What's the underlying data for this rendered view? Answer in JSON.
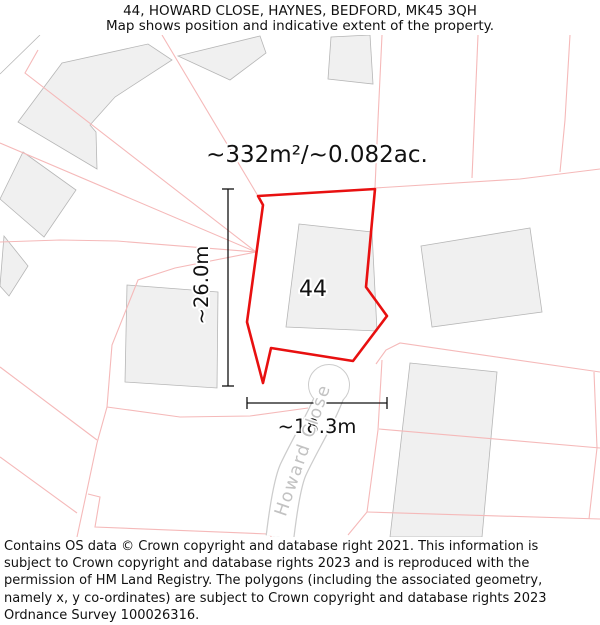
{
  "header": {
    "title": "44, HOWARD CLOSE, HAYNES, BEDFORD, MK45 3QH",
    "subtitle": "Map shows position and indicative extent of the property."
  },
  "map": {
    "area_label": "~332m²/~0.082ac.",
    "plot_number": "44",
    "street_name": "Howard Close",
    "dimensions": {
      "height_label": "~26.0m",
      "width_label": "~18.3m"
    },
    "property_outline_points": "375,189 258,196 263,205 247,322 263,383 271,348 353,361 387,316 366,287",
    "colors": {
      "property_outline": "#e81010",
      "parcel_line": "#f5b9b9",
      "building_fill": "#f0f0f0",
      "building_stroke": "#b6b6b6",
      "street_casing": "#cccccc",
      "street_label": "#c2c2c2",
      "dimension": "#111111"
    }
  },
  "footer": {
    "copyright": "Contains OS data © Crown copyright and database right 2021. This information is subject to Crown copyright and database rights 2023 and is reproduced with the permission of HM Land Registry. The polygons (including the associated geometry, namely x, y co-ordinates) are subject to Crown copyright and database rights 2023 Ordnance Survey 100026316."
  }
}
